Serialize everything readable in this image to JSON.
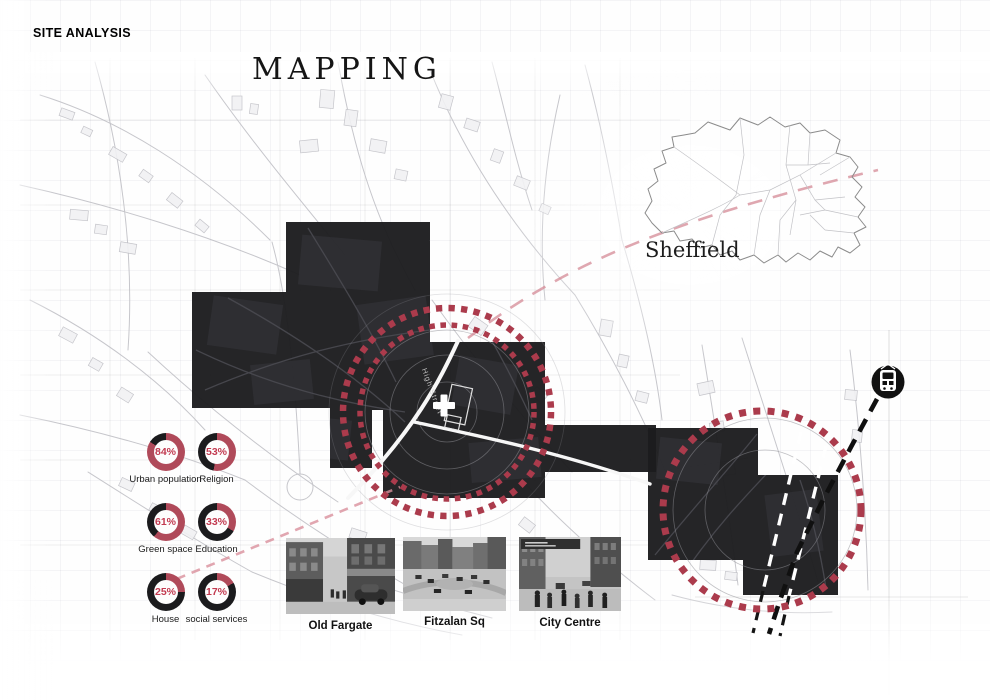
{
  "header": {
    "site_tag": "SITE ANALYSIS",
    "title": "MAPPING"
  },
  "region_map": {
    "label": "Sheffield"
  },
  "map_labels": {
    "street": "High Street"
  },
  "colors": {
    "accent_red": "#B04A5A",
    "percent_red": "#C23A50",
    "donut_dark": "#1B1B1D",
    "mass_dark": "#1C1C1E",
    "pink_dash": "#D9909C"
  },
  "donuts": {
    "items": [
      {
        "label": "Urban population",
        "value": 84
      },
      {
        "label": "Religion",
        "value": 53
      },
      {
        "label": "Green space",
        "value": 61
      },
      {
        "label": "Education",
        "value": 33
      },
      {
        "label": "House",
        "value": 25
      },
      {
        "label": "social services",
        "value": 17
      }
    ]
  },
  "chart_data": {
    "type": "donut-grid",
    "categories": [
      "Urban population",
      "Religion",
      "Green space",
      "Education",
      "House",
      "social services"
    ],
    "values": [
      84,
      53,
      61,
      33,
      25,
      17
    ],
    "title": "Site statistics (% shown in red, remainder black)",
    "legend_position": "below-each-donut"
  },
  "photos": [
    {
      "caption": "Old Fargate"
    },
    {
      "caption": "Fitzalan Sq"
    },
    {
      "caption": "City Centre"
    }
  ]
}
